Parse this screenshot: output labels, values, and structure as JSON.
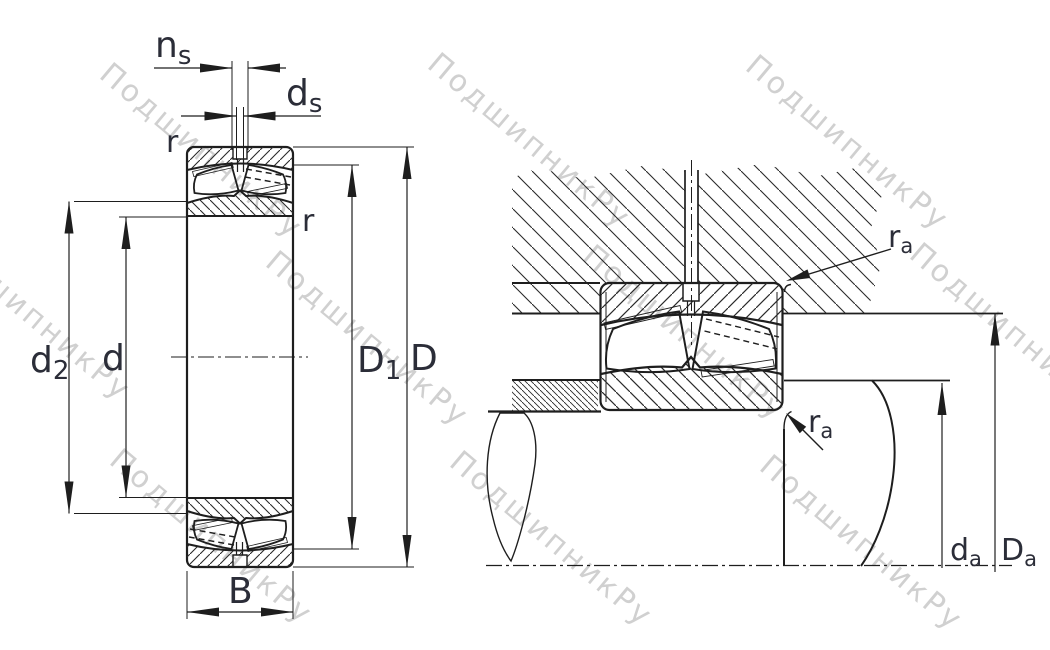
{
  "drawing": {
    "subject": "spherical-roller-bearing-cross-section-and-mounting",
    "views": [
      "bearing cross section",
      "mounted bearing with shaft and housing"
    ]
  },
  "colors": {
    "line": "#1e1e1e",
    "label": "#2b2d38",
    "watermark": "#d0d0d0",
    "background": "#ffffff"
  },
  "watermark": {
    "text": "ПодшипникРу"
  },
  "left_view": {
    "dim_ns": {
      "base": "n",
      "sub": "s"
    },
    "dim_ds": {
      "base": "d",
      "sub": "s"
    },
    "corner_r_top": "r",
    "corner_r_right": "r",
    "dim_d2": {
      "base": "d",
      "sub": "2"
    },
    "dim_d": "d",
    "dim_D1": {
      "base": "D",
      "sub": "1"
    },
    "dim_D": "D",
    "dim_B": "B"
  },
  "right_view": {
    "fillet_ra_top": {
      "base": "r",
      "sub": "a"
    },
    "fillet_ra_bottom": {
      "base": "r",
      "sub": "a"
    },
    "dim_da": {
      "base": "d",
      "sub": "a"
    },
    "dim_Da": {
      "base": "D",
      "sub": "a"
    }
  }
}
